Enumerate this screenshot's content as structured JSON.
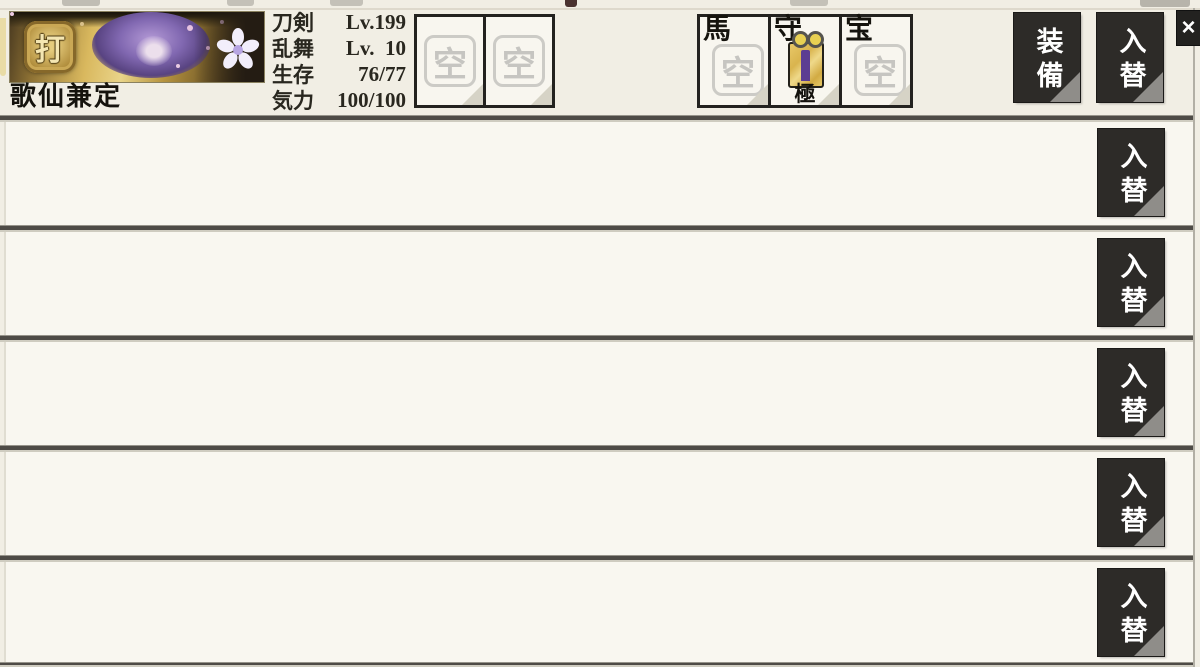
{
  "header": {
    "character": {
      "name": "歌仙兼定",
      "type_badge": "打",
      "stats": [
        {
          "label": "刀剣",
          "value": "Lv.199"
        },
        {
          "label": "乱舞",
          "value": "Lv.  10"
        },
        {
          "label": "生存",
          "value": "76/77"
        },
        {
          "label": "気力",
          "value": "100/100"
        }
      ]
    },
    "equipment_slots": [
      {
        "glyph": "空"
      },
      {
        "glyph": "空"
      }
    ],
    "named_slots": [
      {
        "label": "馬",
        "glyph": "空"
      },
      {
        "label": "守",
        "item": "omamori-charm",
        "badge": "極"
      },
      {
        "label": "宝",
        "glyph": "空"
      }
    ],
    "equip_button_label": "装備",
    "swap_button_label": "入替",
    "close_button_label": "×"
  },
  "rows": [
    {
      "swap_button_label": "入替"
    },
    {
      "swap_button_label": "入替"
    },
    {
      "swap_button_label": "入替"
    },
    {
      "swap_button_label": "入替"
    },
    {
      "swap_button_label": "入替"
    }
  ],
  "colors": {
    "background": "#f1eee4",
    "row_background": "#f9f7f0",
    "button_black": "#2d2b28",
    "separator": "#4e4b46",
    "gold": "#d9b85e",
    "omamori_purple": "#5c3d92"
  }
}
